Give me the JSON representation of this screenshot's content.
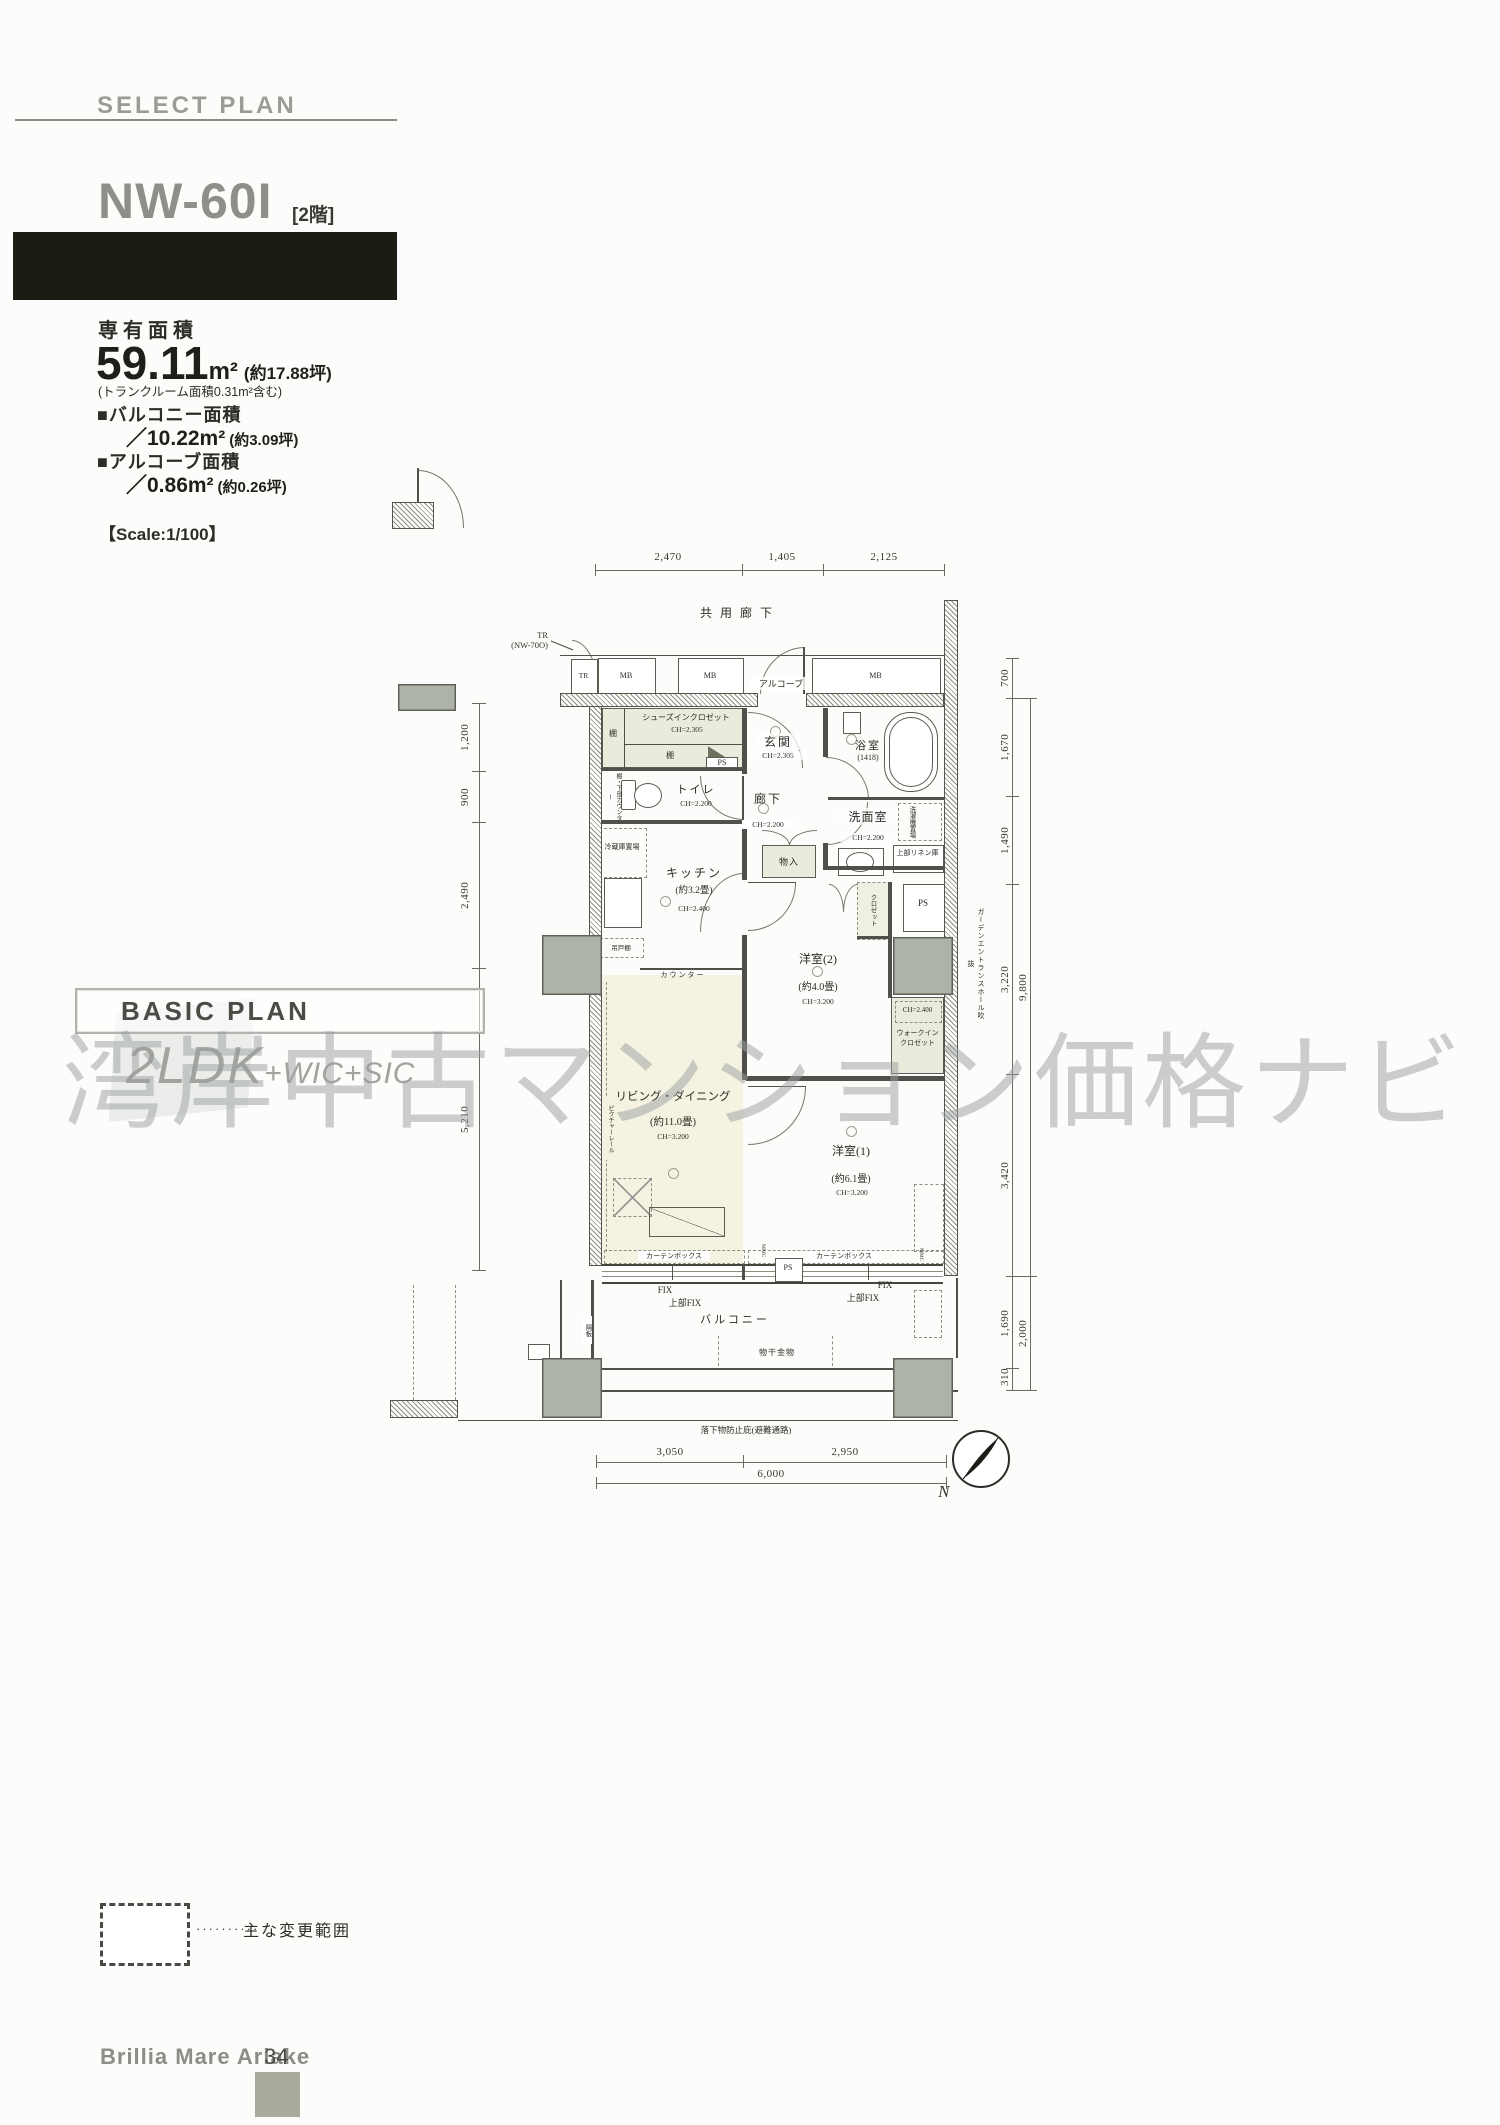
{
  "header": {
    "kicker": "SELECT PLAN",
    "unit_name": "NW-60I",
    "floor_tag": "[2階]"
  },
  "areas": {
    "main_label": "専有面積",
    "main_value": "59.11",
    "main_unit": "m²",
    "main_tsubo": "(約17.88坪)",
    "main_note": "(トランクルーム面積0.31m²含む)",
    "balcony_label": "■バルコニー面積",
    "balcony_value": "／10.22m²",
    "balcony_tsubo": "(約3.09坪)",
    "alcove_label": "■アルコーブ面積",
    "alcove_value": "／0.86m²",
    "alcove_tsubo": "(約0.26坪)"
  },
  "scale_note": "【Scale:1/100】",
  "basic_plan": {
    "title": "BASIC PLAN",
    "layout_main": "2LDK",
    "layout_sub": "+WIC+SIC"
  },
  "watermark": "湾岸中古マンション価格ナビ",
  "legend": {
    "dots": "··········",
    "label": "主な変更範囲"
  },
  "footer": {
    "building": "Brillia Mare Ariake",
    "page": "34"
  },
  "plan": {
    "corridor": "共用廊下",
    "tr_ref_line1": "TR",
    "tr_ref_line2": "(NW-70O)",
    "boxes": {
      "tr": "TR",
      "mb": "MB",
      "alcove": "アルコーブ"
    },
    "rooms": {
      "sic": "シューズインクロゼット",
      "sic_ch": "CH=2.305",
      "shelf": "棚",
      "toilet": "トイレ",
      "toilet_ch": "CH=2.200",
      "toilet_side": "棚・下部カウンター",
      "genkan": "玄関",
      "genkan_ch": "CH=2.305",
      "bath": "浴室",
      "bath_size": "(1418)",
      "hall": "廊下",
      "hall_ch": "CH=2.200",
      "wash": "洗面室",
      "wash_ch": "CH=2.200",
      "washer": "洗濯機置場",
      "linen": "上部リネン庫",
      "fridge": "冷蔵庫置場",
      "kitchen": "キッチン",
      "kitchen_size": "(約3.2畳)",
      "kitchen_ch": "CH=2.400",
      "hanging": "吊戸棚",
      "counter": "カウンター",
      "mono": "物入",
      "west2": "洋室(2)",
      "west2_size": "(約4.0畳)",
      "west2_ch": "CH=3.200",
      "closet": "クロゼット",
      "ps": "PS",
      "wic_ch": "CH=2.400",
      "wic_line1": "ウォークイン",
      "wic_line2": "クロゼット",
      "living": "リビング・ダイニング",
      "living_size": "(約11.0畳)",
      "living_ch": "CH=3.200",
      "rail": "ピクチャーレール",
      "west1": "洋室(1)",
      "west1_size": "(約6.1畳)",
      "west1_ch": "CH=3.200",
      "curtain": "カーテンボックス",
      "fix": "FIX",
      "fix_upper": "上部FIX",
      "mmc": "MMC",
      "balcony": "バルコニー",
      "monohoshi": "物干金物",
      "divider": "隔板",
      "canopy": "落下物防止庇(避難通路)",
      "garden": "ガーデンエントランスホール吹抜"
    },
    "dims": {
      "top": [
        "2,470",
        "1,405",
        "2,125"
      ],
      "left": [
        "1,200",
        "900",
        "2,490",
        "5,210"
      ],
      "right": [
        "700",
        "1,670",
        "1,490",
        "3,220",
        "9,800",
        "3,420",
        "1,690",
        "2,000",
        "310"
      ],
      "bottom": [
        "3,050",
        "2,950",
        "6,000"
      ]
    },
    "north": "N"
  }
}
